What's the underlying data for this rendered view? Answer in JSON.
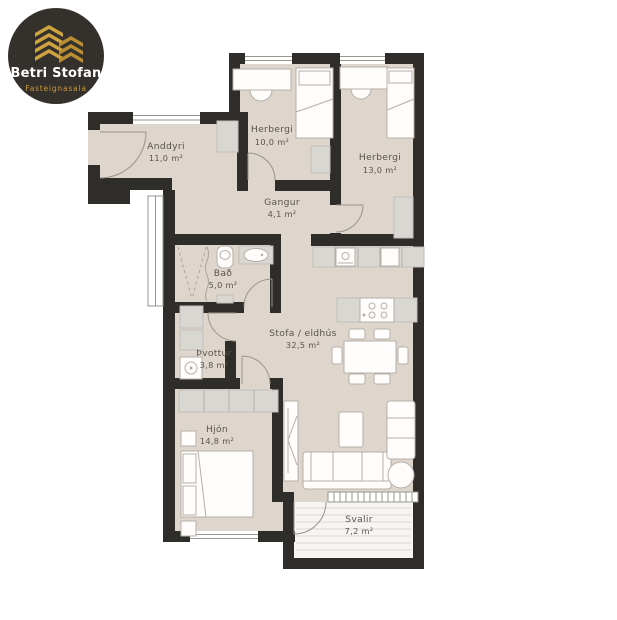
{
  "logo": {
    "brand": "Betri Stofan",
    "tagline": "Fasteignasala"
  },
  "rooms": {
    "anddyri": {
      "name": "Anddyri",
      "area": "11,0 m²"
    },
    "herbergi1": {
      "name": "Herbergi",
      "area": "10,0 m²"
    },
    "herbergi2": {
      "name": "Herbergi",
      "area": "13,0 m²"
    },
    "gangur": {
      "name": "Gangur",
      "area": "4,1 m²"
    },
    "bad": {
      "name": "Bað",
      "area": "5,0 m²"
    },
    "thvottur": {
      "name": "Þvottur",
      "area": "3,8 m²"
    },
    "stofa": {
      "name": "Stofa / eldhús",
      "area": "32,5 m²"
    },
    "hjon": {
      "name": "Hjón",
      "area": "14,8 m²"
    },
    "svalir": {
      "name": "Svalir",
      "area": "7,2 m²"
    }
  },
  "colors": {
    "wall": "#2f2d2a",
    "floor": "#ded6cc",
    "logo_bg": "#34302c",
    "logo_gold": "#cfa440",
    "label_text": "#59544d",
    "balcony_floor": "#f6f5f2"
  }
}
